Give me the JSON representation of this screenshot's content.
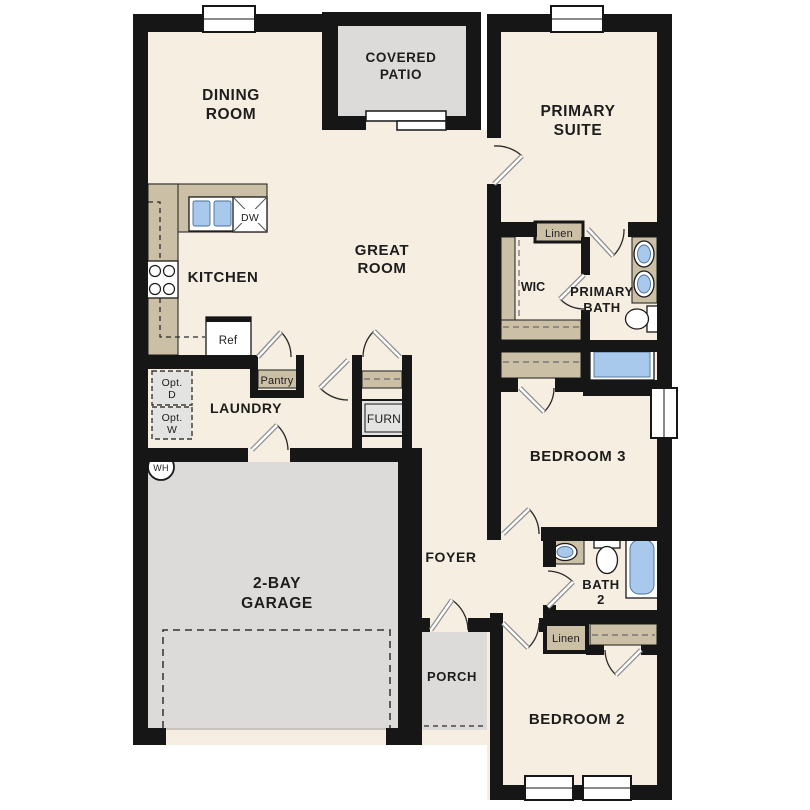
{
  "labels": {
    "dining_1": "DINING",
    "dining_2": "ROOM",
    "patio_1": "COVERED",
    "patio_2": "PATIO",
    "primary_1": "PRIMARY",
    "primary_2": "SUITE",
    "great_1": "GREAT",
    "great_2": "ROOM",
    "kitchen": "KITCHEN",
    "wic": "WIC",
    "pbath_1": "PRIMARY",
    "pbath_2": "BATH",
    "linen_top": "Linen",
    "laundry": "LAUNDRY",
    "pantry": "Pantry",
    "furn": "FURN",
    "ref": "Ref",
    "dw": "DW",
    "opt_d_1": "Opt.",
    "opt_d_2": "D",
    "opt_w_1": "Opt.",
    "opt_w_2": "W",
    "wh": "WH",
    "bedroom3": "BEDROOM 3",
    "garage_1": "2-BAY",
    "garage_2": "GARAGE",
    "foyer": "FOYER",
    "bath2_1": "BATH",
    "bath2_2": "2",
    "linen_hall": "Linen",
    "porch": "PORCH",
    "bedroom2": "BEDROOM 2"
  },
  "colors": {
    "wall": "#161616",
    "floor": "#f6eee0",
    "millwork_tan": "#cbbfa6",
    "concrete_gray": "#dcdbd9",
    "fixture_blue": "#a9c9ec",
    "optional_item_gray": "#e3e3e1"
  }
}
